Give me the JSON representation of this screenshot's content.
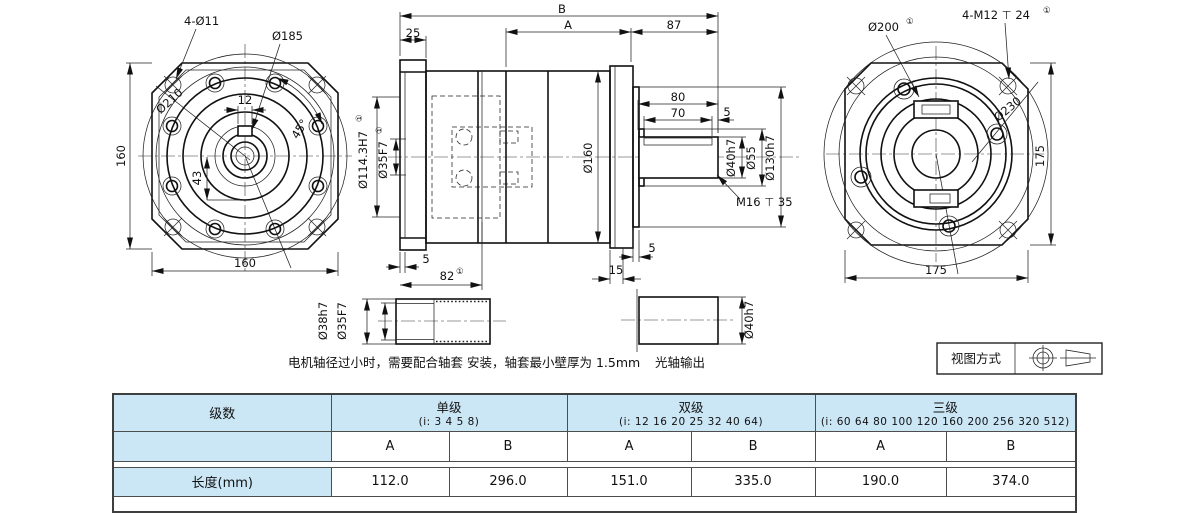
{
  "drawing": {
    "footnote": "①",
    "front": {
      "bolt_holes": "4-Ø11",
      "d185": "Ø185",
      "d210": "Ø210",
      "key_w": "12",
      "angle": "45°",
      "d43": "43",
      "height": "160",
      "width": "160"
    },
    "side": {
      "B": "B",
      "A": "A",
      "d25": "25",
      "d87": "87",
      "d80": "80",
      "d70": "70",
      "d5_top": "5",
      "d160": "Ø160",
      "d114": "Ø114.3H7",
      "d35": "Ø35F7",
      "d40": "Ø40h7",
      "d55": "Ø55",
      "d130": "Ø130h7",
      "m16": "M16 ⊤ 35",
      "d5_left": "5",
      "d82": "82",
      "d15": "15",
      "d5_right": "5"
    },
    "rear": {
      "d200": "Ø200",
      "m12": "4-M12 ⊤ 24",
      "d230": "Ø230",
      "height": "175",
      "width": "175"
    },
    "sleeve": {
      "d38": "Ø38h7",
      "d35": "Ø35F7",
      "note": "电机轴径过小时，需要配合轴套 安装，轴套最小壁厚为 1.5mm"
    },
    "shaft": {
      "d40": "Ø40h7",
      "caption": "光轴输出"
    },
    "view_method": {
      "label": "视图方式"
    }
  },
  "table": {
    "stage_header": "级数",
    "length_label": "长度(mm)",
    "col_a": "A",
    "col_b": "B",
    "groups": [
      {
        "name": "单级",
        "ratios": "(i: 3 4 5 8)",
        "a": "112.0",
        "b": "296.0"
      },
      {
        "name": "双级",
        "ratios": "(i: 12 16 20 25 32 40 64)",
        "a": "151.0",
        "b": "335.0"
      },
      {
        "name": "三级",
        "ratios": "(i: 60 64 80 100 120 160 200 256 320 512)",
        "a": "190.0",
        "b": "374.0"
      }
    ]
  }
}
